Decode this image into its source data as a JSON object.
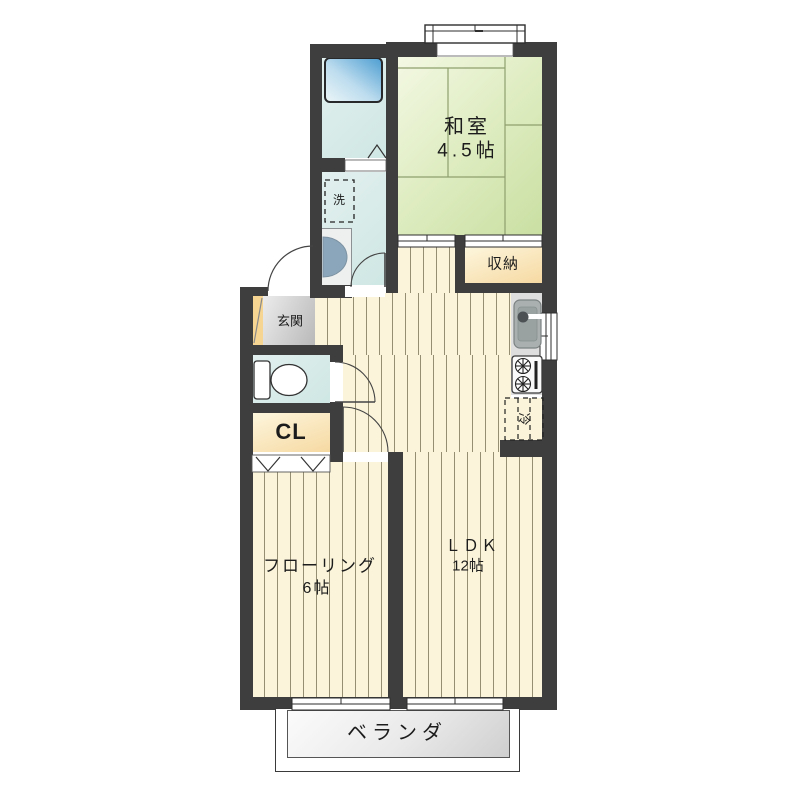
{
  "plan": {
    "type": "apartment-floor-plan",
    "rooms": {
      "washitsu": {
        "name": "和室",
        "size": "4.5帖"
      },
      "ldk": {
        "name": "ＬＤＫ",
        "size": "12帖"
      },
      "flooring": {
        "name": "フローリング",
        "size": "6帖"
      },
      "storage": {
        "name": "収納"
      },
      "closet": {
        "name": "CL"
      },
      "entrance": {
        "name": "玄関"
      },
      "veranda": {
        "name": "ベランダ"
      }
    },
    "fixtures": {
      "laundry": "洗",
      "fridge": "冷"
    },
    "colors": {
      "wall": "#3e3e3e",
      "tatami_green": "#d5e6b0",
      "floor_cream": "#fbf4da",
      "wet_area_cyan": "#d4e8e5",
      "storage_cream": "#f6d9a2",
      "bathtub_blue": "#4f9fd2",
      "veranda_gray": "#d9d9d9",
      "entrance_tile": "#c9c9c9",
      "entrance_step": "#f6d593"
    }
  }
}
